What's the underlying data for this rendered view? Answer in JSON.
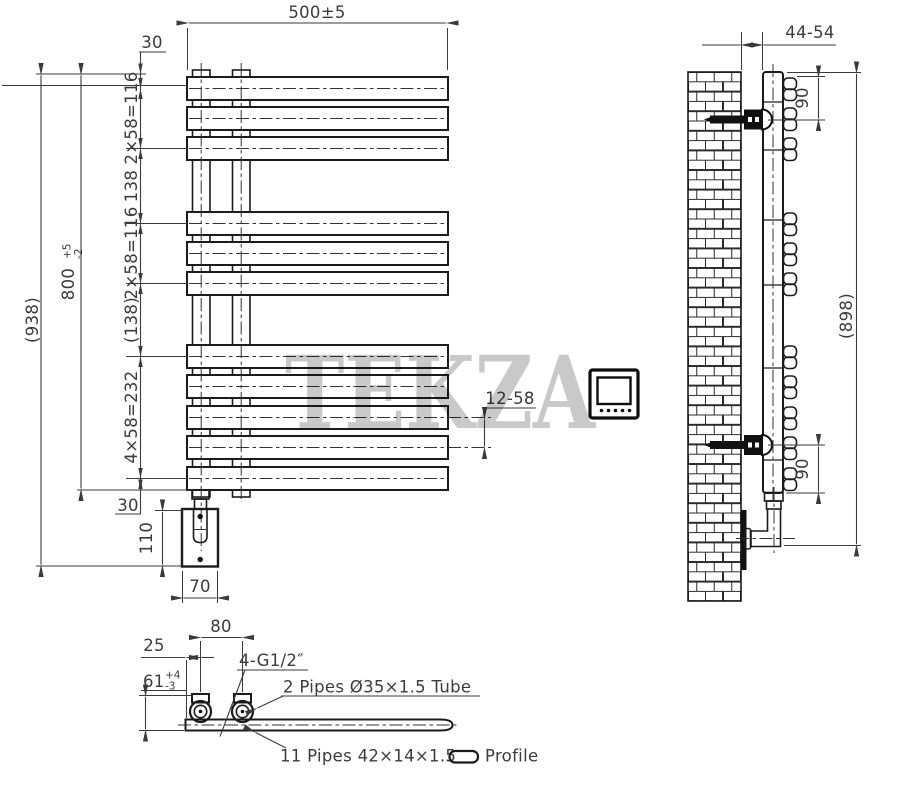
{
  "watermark": "TEKZA",
  "front": {
    "width": "500±5",
    "top_offset": "30",
    "group1": "2×58=116",
    "gap1": "138",
    "group2": "2×58=116",
    "gap2": "(138)",
    "group3": "4×58=232",
    "bottom_offset": "30",
    "height_value": "800",
    "height_tol_plus": "+5",
    "height_tol_minus": "-2",
    "overall": "(938)",
    "bar_gap": "12-58",
    "bracket_height": "110",
    "bracket_width": "70"
  },
  "side": {
    "wall_distance": "44-54",
    "top_spacing": "90",
    "bottom_spacing": "90",
    "overall": "(898)"
  },
  "section": {
    "pipe_offset": "25",
    "pipe_spacing": "80",
    "height_value": "61",
    "height_tol_plus": "+4",
    "height_tol_minus": "-3",
    "thread": "4-G1/2″",
    "tube": "2 Pipes Ø35×1.5 Tube",
    "profiles": "11 Pipes 42×14×1.5",
    "profile_label": "Profile"
  }
}
